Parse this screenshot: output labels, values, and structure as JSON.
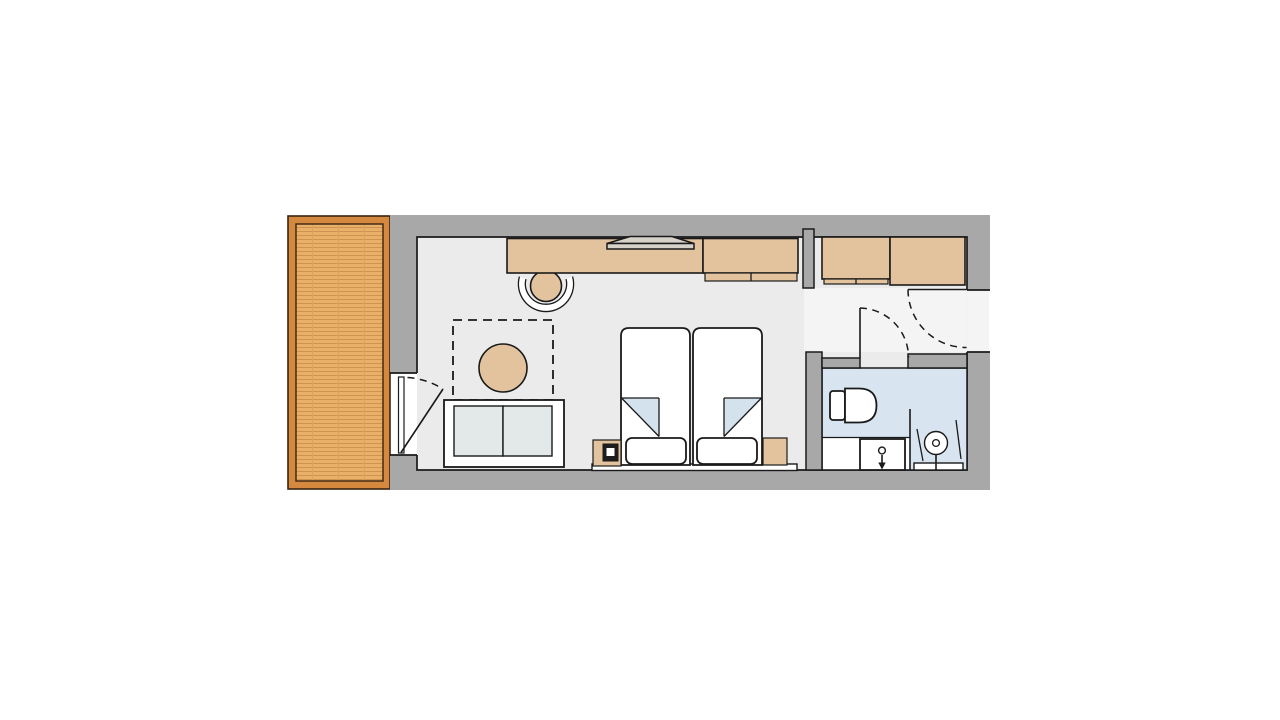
{
  "app": {
    "type": "architectural-floor-plan",
    "subject": "hotel-room-with-balcony"
  },
  "colors": {
    "wall": "#a8a8a8",
    "ink": "#1a1a1a",
    "floor": "#ebebeb",
    "hall": "#f4f4f4",
    "wood": "#e2c39e",
    "cushion": "#e3e8e8",
    "bathfloor": "#d8e4ef",
    "fold": "#d4e2ee",
    "tv": "#d6d2ca",
    "phone": "#1d1d1d",
    "deckband": "#d4893f",
    "deckplank": "#e9b06a",
    "deckline": "#cf9350",
    "deckline2": "#3a2310"
  },
  "rooms": [
    {
      "name": "balcony",
      "floor": "wood-deck"
    },
    {
      "name": "living-bedroom",
      "floor": "light-gray"
    },
    {
      "name": "entry-hall",
      "floor": "light-gray"
    },
    {
      "name": "bathroom",
      "floor": "light-blue"
    }
  ],
  "furniture": {
    "living_bedroom": [
      "desk-counter",
      "tv-icon",
      "desk-chair",
      "wardrobe",
      "entry-wardrobe",
      "rug-dashed-area",
      "round-side-table",
      "two-seat-sofa",
      "twin-bed-left",
      "twin-bed-right",
      "pillow-left",
      "pillow-right",
      "nightstand-left",
      "telephone-icon",
      "nightstand-right",
      "headboard-board"
    ],
    "bathroom": [
      "toilet",
      "vanity-sink",
      "faucet-icon",
      "shower-glass-panel",
      "shower-head-icon",
      "shower-rail"
    ]
  },
  "doors": [
    {
      "name": "balcony-door",
      "type": "hinged-glass",
      "swing": "into-room"
    },
    {
      "name": "bathroom-door",
      "type": "hinged",
      "swing": "into-hall"
    },
    {
      "name": "entrance-door",
      "type": "hinged",
      "swing": "into-hall"
    }
  ]
}
